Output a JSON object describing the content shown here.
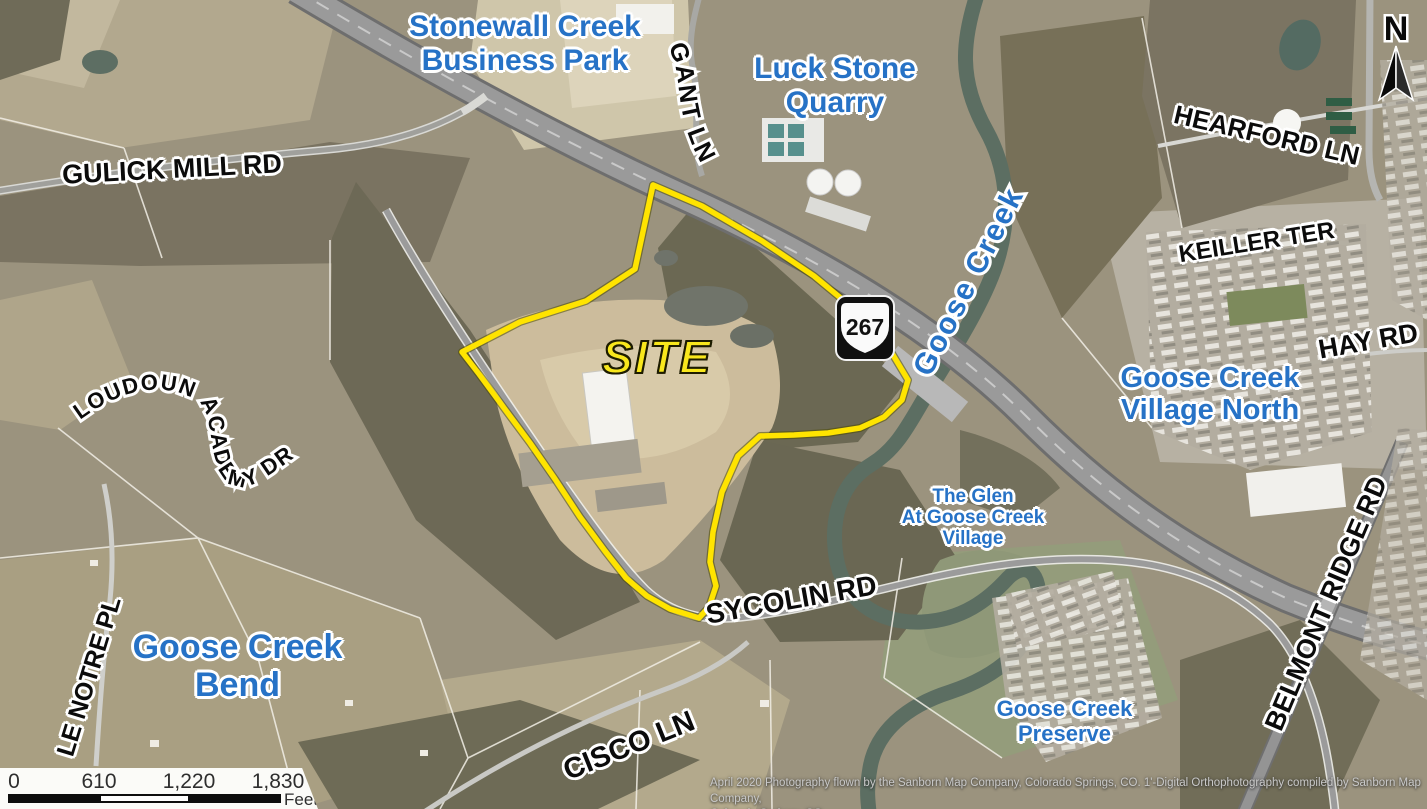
{
  "places": {
    "stonewall_business_park": {
      "line1": "Stonewall Creek",
      "line2": "Business Park"
    },
    "luck_stone_quarry": {
      "line1": "Luck Stone",
      "line2": "Quarry"
    },
    "goose_creek_village_north": {
      "line1": "Goose Creek",
      "line2": "Village North"
    },
    "the_glen": {
      "line1": "The Glen",
      "line2": "At Goose Creek",
      "line3": "Village"
    },
    "goose_creek_bend": {
      "line1": "Goose Creek",
      "line2": "Bend"
    },
    "goose_creek_preserve": {
      "line1": "Goose Creek",
      "line2": "Preserve"
    }
  },
  "roads": {
    "gulick_mill_rd": "GULICK MILL RD",
    "gant_ln": "GANT LN",
    "hearford_ln": "HEARFORD LN",
    "keiller_ter": "KEILLER TER",
    "hay_rd": "HAY RD",
    "loudoun_academy_dr": "LOUDOUN ACADEMY DR",
    "belmont_ridge_rd": "BELMONT RIDGE RD",
    "sycolin_rd": "SYCOLIN RD",
    "le_notre_pl": "LE NOTRE PL",
    "cisco_ln": "CISCO LN"
  },
  "water": {
    "goose_creek": "Goose Creek"
  },
  "site": {
    "label": "SITE"
  },
  "route_shield": {
    "number": "267"
  },
  "north_arrow": {
    "label": "N"
  },
  "scale_bar": {
    "ticks": [
      "0",
      "610",
      "1,220",
      "1,830"
    ],
    "unit": "Feet"
  },
  "credits": {
    "line1": "April 2020 Photography flown by the Sanborn Map Company, Colorado Springs, CO. 1'-Digital Orthophotography compiled by Sanborn Map Company,",
    "line2": "Colorado Springs, CO."
  },
  "colors": {
    "place_label": "#2672c6",
    "road_label": "#0b0b0b",
    "site_label": "#f8e71c",
    "site_boundary": "#ffe400"
  }
}
